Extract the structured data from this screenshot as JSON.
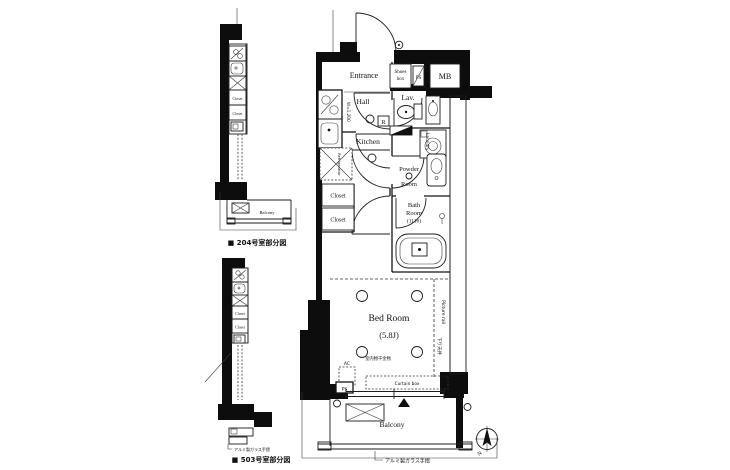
{
  "main_plan": {
    "entrance": "Entrance",
    "shoes_box_l1": "Shoes",
    "shoes_box_l2": "box",
    "ps_top": "PS",
    "mb": "MB",
    "hall": "Hall",
    "lav": "Lav.",
    "kitchen": "Kitchen",
    "kitchen_width": "W=1,200",
    "r_mark": "R",
    "refrigerator": "Refrigerator",
    "laundry": "Laundry",
    "powder_l1": "Powder",
    "powder_l2": "Room",
    "closet_upper": "Closet",
    "closet_lower": "Closet",
    "bath_l1": "Bath",
    "bath_l2": "Room",
    "bath_size": "(1116)",
    "bed_room": "Bed Room",
    "bed_size": "(5.8J)",
    "indoor_hanger": "室内物干金物",
    "picture_rail": "Picture rail",
    "dropped_ceiling": "下り天井",
    "ac": "AC",
    "ps_bottom": "PS",
    "curtain_box": "Curtain box",
    "balcony": "Balcony",
    "rail_label": "アルミ製ガラス手摺",
    "compass_n": "N"
  },
  "plan_204": {
    "caption": "■ 204号室部分図",
    "closet_1": "Closet",
    "closet_2": "Closet",
    "balcony": "Balcony"
  },
  "plan_503": {
    "caption": "■ 503号室部分図",
    "closet_1": "Closet",
    "closet_2": "Closet",
    "rail_label": "アルミ製ガラス手摺"
  }
}
